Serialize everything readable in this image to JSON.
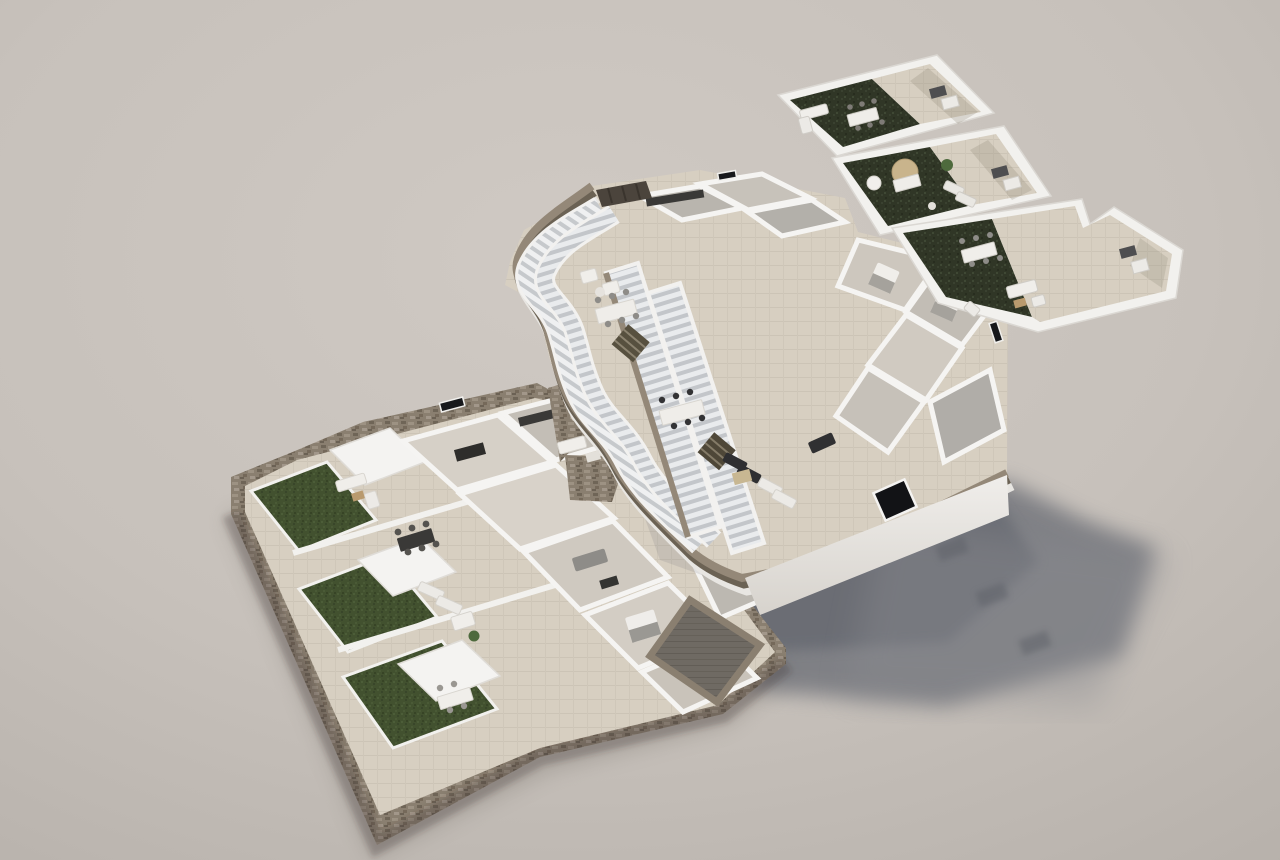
{
  "scene": {
    "title": "Exploded 3D floor-plan render of a three-level residential building",
    "style": "architectural axonometric visualization, photorealistic, contains no text or UI controls",
    "lighting": "soft daylight from the upper right; parapets cast streaks onto decks and the floating upper floor casts a large soft shadow on the ground to the lower right",
    "levels": [
      {
        "name": "roof-terrace-level",
        "position": "top-right",
        "terraces": [
          {
            "name": "terrace-1",
            "surfaces": [
              "artificial turf",
              "cream tile deck"
            ],
            "furniture": [
              "white lounge sofa",
              "coffee table",
              "dining table with six chairs",
              "bbq grill counter"
            ]
          },
          {
            "name": "terrace-2",
            "surfaces": [
              "artificial turf",
              "cream tile deck"
            ],
            "furniture": [
              "tan parasol",
              "outdoor dining table",
              "potted plant",
              "two sun loungers",
              "white side parasol",
              "bbq grill counter"
            ]
          },
          {
            "name": "terrace-3",
            "surfaces": [
              "artificial turf",
              "cream tile deck"
            ],
            "furniture": [
              "white dining table with chairs",
              "white outdoor sofa set",
              "lounge chair",
              "bbq grill counter"
            ]
          }
        ]
      },
      {
        "name": "upper-floor",
        "position": "center",
        "features": [
          "zigzag taupe slab rim",
          "dark slatted canopy at north-west corner",
          "two long parallel white outdoor staircases snaking along the rim",
          "upper stair flight at the tip",
          "open-top rooms: kitchen, bedrooms, bathrooms",
          "two interior dark stair flights",
          "terrace with white dining tables and armchairs",
          "terrace with black and white sun loungers",
          "hanging south facade with black window"
        ]
      },
      {
        "name": "ground-floor",
        "position": "bottom-left",
        "features": [
          "rubble stone perimeter wall",
          "three private lawns",
          "three white pergola canopies",
          "outdoor dining sets",
          "white sun loungers and day bed",
          "living-dining rooms with grey sofas",
          "kitchens with dark counters",
          "bedroom with double bed",
          "stone-walled courtyard with dark timber deck",
          "stone retaining wedges toward the upper floor"
        ]
      }
    ],
    "connections": "two long parallel outdoor staircases descend across the upper floor toward the ground-floor stone courtyard"
  },
  "palette": {
    "background": "#c7c1bb",
    "background_light": "#cfc9c3",
    "background_dark": "#b7b1ab",
    "wall_white": "#f3f2ef",
    "wall_shade": "#dbd8d3",
    "terrace_tile": "#d7cfc1",
    "interior_floor": "#cdc7be",
    "interior_floor_dark": "#b3b0aa",
    "slab_rim_top": "#948878",
    "slab_rim_side": "#6b6254",
    "stone_wall": "#8a7f70",
    "courtyard_deck": "#6f6a63",
    "garden_grass": "#42512f",
    "roof_turf": "#303626",
    "stair_tread": "#e9ebed",
    "stair_tread_shadow": "#c3c6ca",
    "shadow": "#6e7178",
    "furniture_white": "#f0eeea",
    "furniture_grey": "#8e8c88",
    "furniture_dark": "#333335",
    "parasol_tan": "#c9b48c",
    "plant_green": "#4e6a3d",
    "wood": "#b99a6e",
    "canopy_dark": "#4b443c",
    "window_glass": "#17181b"
  }
}
